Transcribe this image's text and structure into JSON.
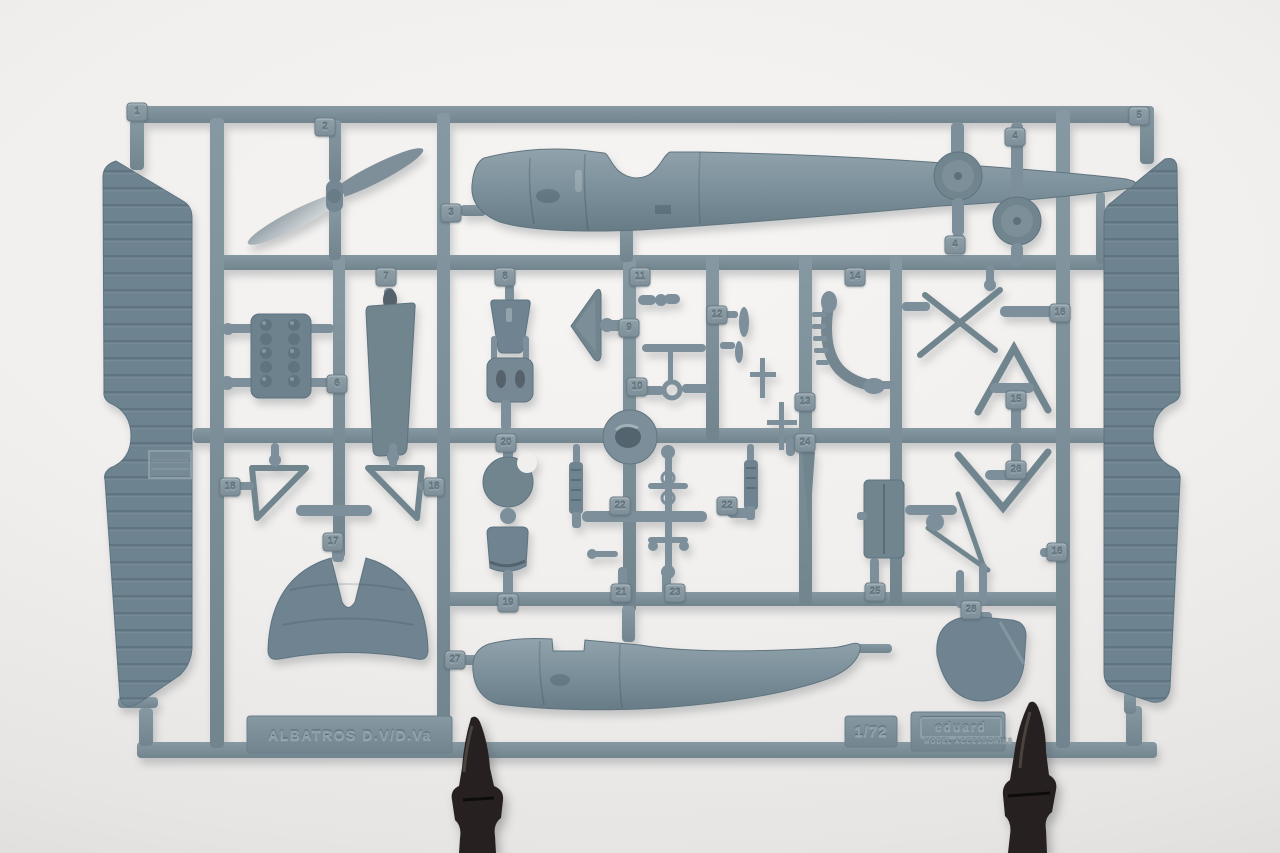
{
  "frame": {
    "nameplate_text": "ALBATROS  D.V/D.Va",
    "scale_text": "1/72",
    "brand_text": "eduard",
    "brand_subtext": "MODEL ACCESSORIES",
    "part_tags": [
      "1",
      "2",
      "3",
      "4",
      "4",
      "5",
      "6",
      "7",
      "8",
      "9",
      "10",
      "11",
      "12",
      "13",
      "14",
      "15",
      "16",
      "16",
      "17",
      "18",
      "18",
      "19",
      "20",
      "21",
      "22",
      "22",
      "23",
      "24",
      "25",
      "26",
      "27",
      "28"
    ]
  },
  "colors": {
    "plastic": "#7c8f9a",
    "plastic_dark": "#677b86",
    "plastic_light": "#94a5ae",
    "wing_plastic": "#6e8390",
    "background": "#f1efed",
    "clip_black": "#262120"
  }
}
